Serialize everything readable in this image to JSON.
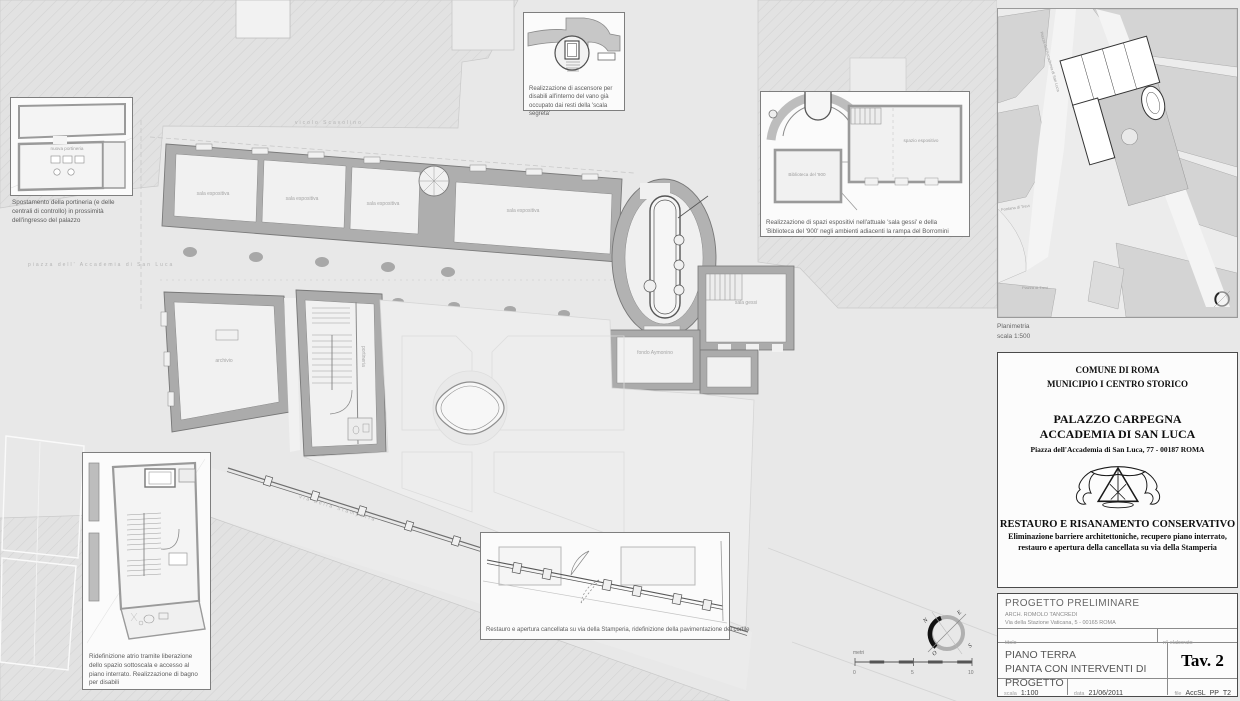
{
  "plan": {
    "streets": {
      "top": "vicolo Scavolino",
      "left": "piazza dell' Accademia di San Luca",
      "diagonal": "via della Stamperia"
    },
    "rooms": {
      "sala_espositiva": "sala espositiva",
      "archivio": "archivio",
      "portineria": "portineria",
      "sala_gessi": "sala gessi",
      "fondo_aymonino": "fondo Aymonino"
    },
    "compass": {
      "n": "N",
      "e": "E",
      "s": "S",
      "o": "O"
    },
    "scalebar": {
      "unit": "metri",
      "t0": "0",
      "t5": "5",
      "t10": "10"
    }
  },
  "callouts": {
    "portineria": {
      "room": "nuova portineria",
      "caption": "Spostamento della portineria (e delle centrali di controllo) in prossimità dell'ingresso del palazzo"
    },
    "ascensore": {
      "caption": "Realizzazione di ascensore per disabili all'interno del vano già occupato dai resti della 'scala segreta'"
    },
    "spazi_espositivi": {
      "room1": "spazio espositivo",
      "room2": "Biblioteca del '900",
      "caption": "Realizzazione di spazi espositivi nell'attuale 'sala gessi' e della 'Biblioteca del '900' negli ambienti adiacenti la rampa del Borromini"
    },
    "atrio": {
      "caption": "Ridefinizione atrio tramite liberazione dello spazio sottoscala e accesso al piano interrato. Realizzazione di bagno per disabili"
    },
    "cancellata": {
      "caption": "Restauro e apertura cancellata su via della Stamperia, ridefinizione della pavimentazione del cortile"
    }
  },
  "map": {
    "caption1": "Planimetria",
    "caption2": "scala 1:500",
    "label_piazza_accademia": "Piazza dell'Accademia di San Luca",
    "label_fontana": "Fontana di Trevi",
    "label_piazza_trevi": "Piazza di Trevi"
  },
  "titleblock": {
    "muni1": "COMUNE DI ROMA",
    "muni2": "MUNICIPIO I CENTRO STORICO",
    "building1": "PALAZZO CARPEGNA",
    "building2": "ACCADEMIA DI SAN LUCA",
    "address": "Piazza dell'Accademia di San Luca, 77 - 00187 ROMA",
    "project_title": "RESTAURO E RISANAMENTO CONSERVATIVO",
    "project_sub1": "Eliminazione barriere architettoniche, recupero piano interrato,",
    "project_sub2": "restauro e apertura della cancellata su via della Stamperia",
    "phase": "PROGETTO PRELIMINARE",
    "architect": "ARCH. ROMOLO TANCREDI",
    "architect_address": "Via della Stazione Vaticana, 5 - 00165 ROMA",
    "label_titolo": "titolo",
    "label_elaborato": "n°  elaborato",
    "title_line1": "PIANO TERRA",
    "title_line2": "PIANTA CON INTERVENTI DI PROGETTO",
    "tav": "Tav. 2",
    "label_scala": "scala",
    "scala": "1:100",
    "label_data": "data",
    "data": "21/06/2011",
    "label_file": "file",
    "file": "AccSL_PP_T2"
  }
}
